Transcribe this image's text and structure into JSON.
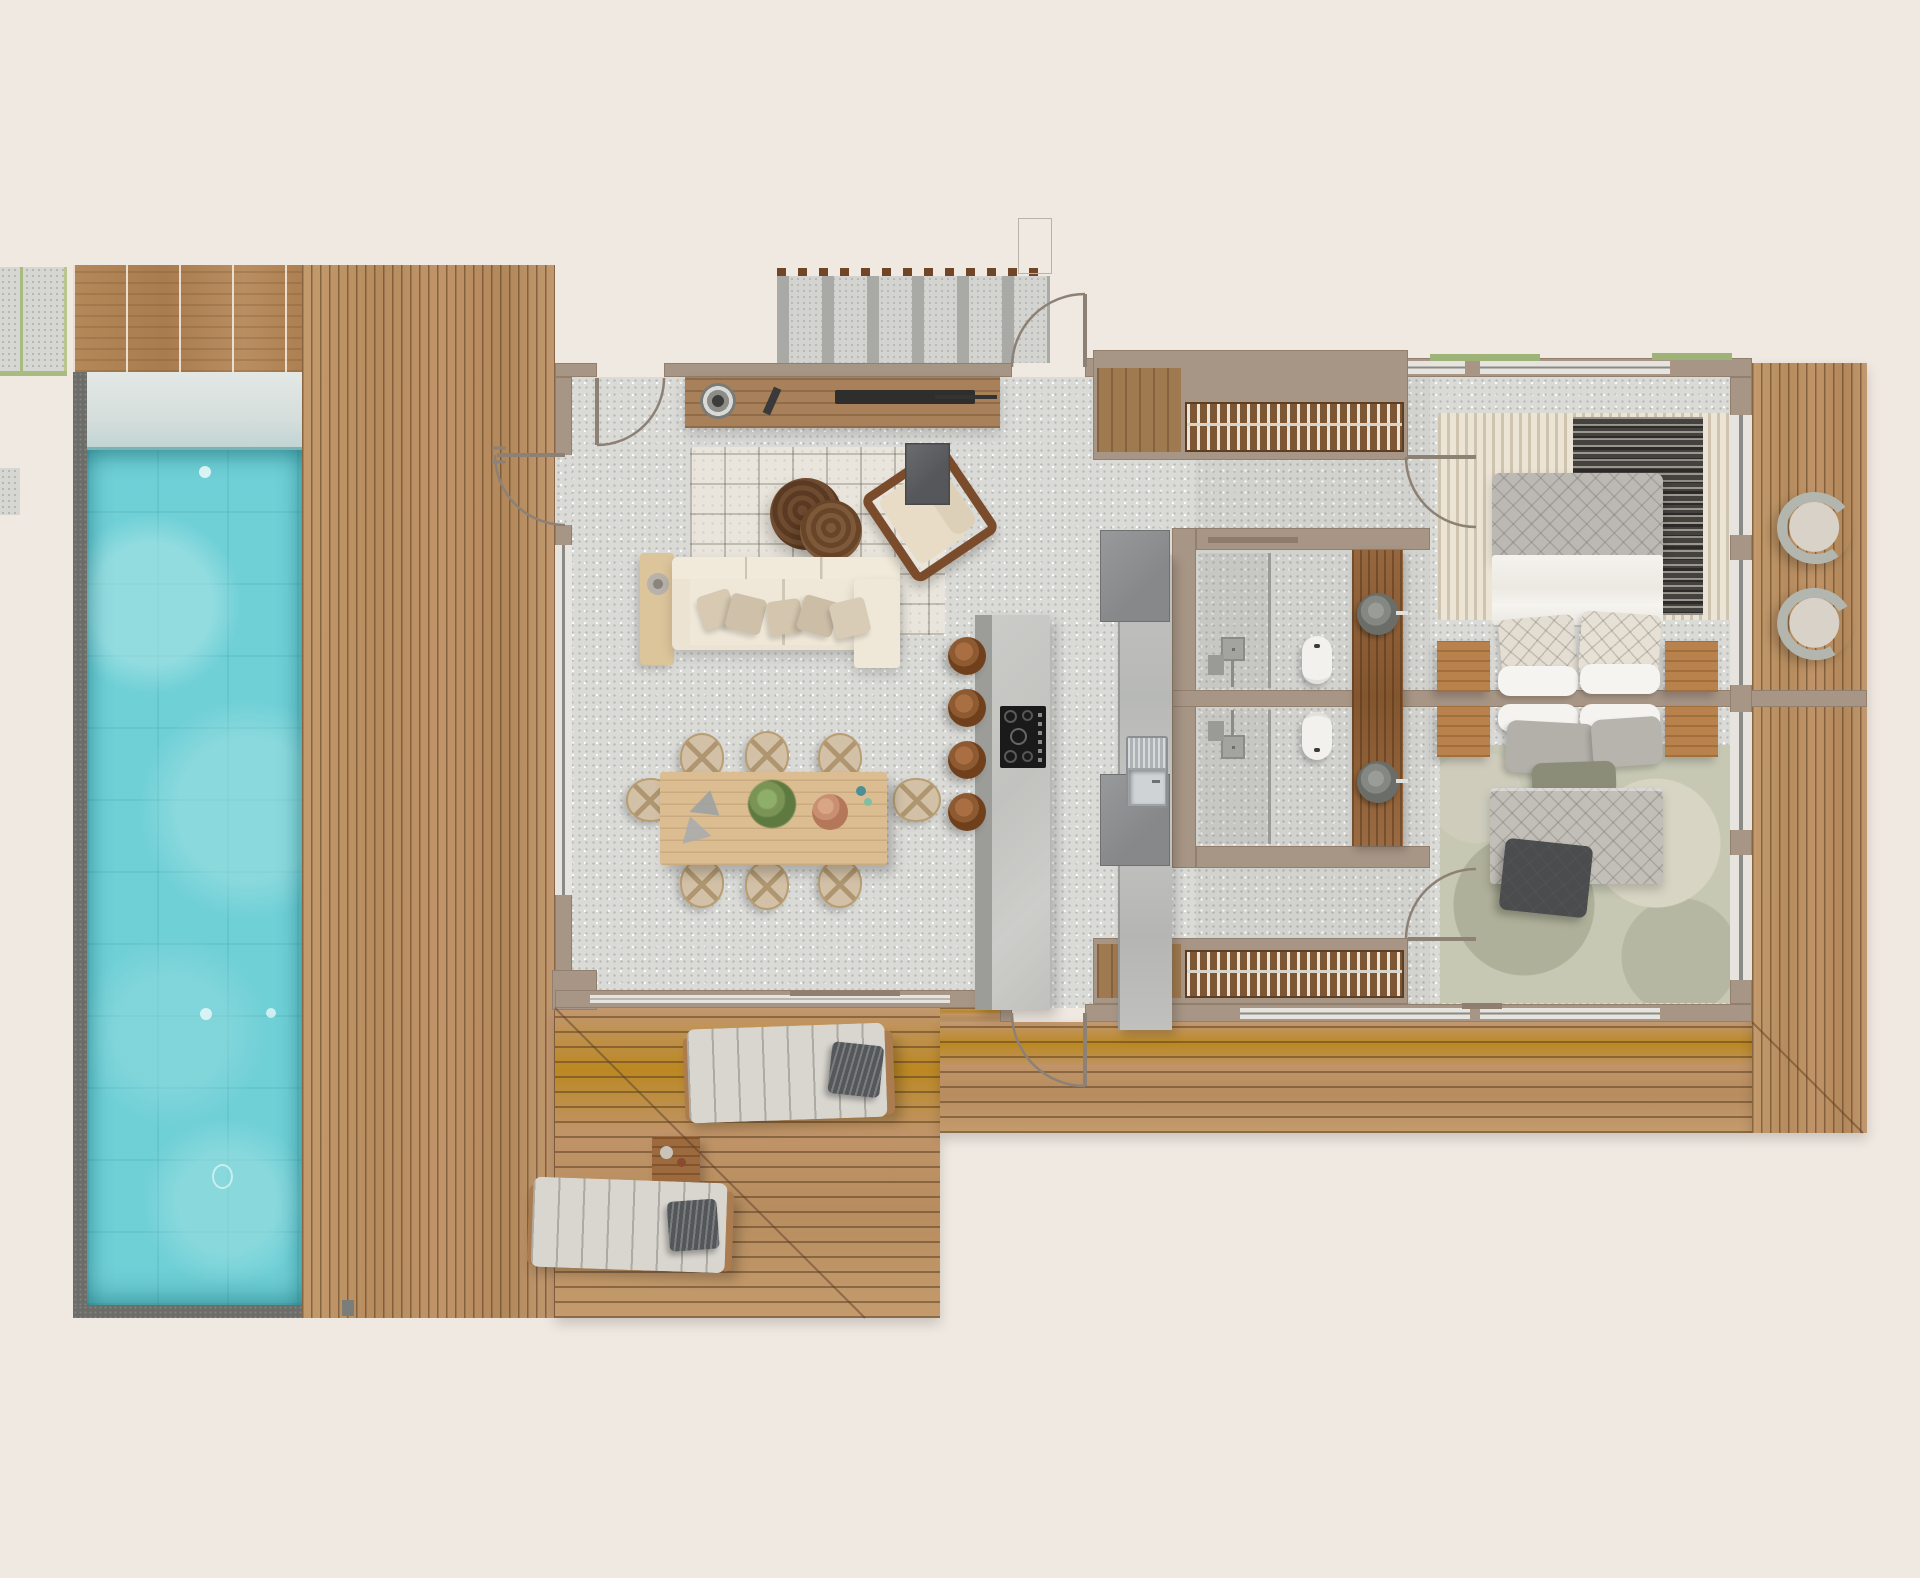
{
  "plan": {
    "type": "villa-floor-plan-top-view",
    "colors": {
      "bg": "#f0e9e1",
      "wall": "#a79585",
      "floor": "#dadad7",
      "deck_wood": "#bf9569",
      "deck_gap": "#8a6440",
      "pool_water": "#6fd0d6",
      "pool_shelf": "#dde4e0",
      "pool_coping": "#6c6c68",
      "door": "#8d8175",
      "grass": "#9db377",
      "concrete_path": "#d3d3d0",
      "path_slat": "#a9a9a6",
      "pergola_dash": "#6f4627",
      "sofa_cream": "#ece3d2",
      "pillow_beige": "#d6c8b1",
      "rug_cream": "#e9e5dc",
      "rug_dark": "#44423e",
      "rug_sage": "#c6c8b4",
      "coffee_table_walnut": "#64422a",
      "dining_table": "#dcbd91",
      "chair_seat": "#d2c1a6",
      "stool_walnut": "#8d5a32",
      "island_stone": "#c7c7c4",
      "counter_stone": "#bdbeba",
      "cooktop": "#1a1a1a",
      "stainless": "#c9cdcf",
      "fridge": "#8e908f",
      "console_wood": "#a8805a",
      "vanity_wood": "#8f603a",
      "nightstand_wood": "#b9824c",
      "rack_wood": "#7d5634",
      "rack_slat": "#eae5da",
      "headboard_grey": "#bcb8b3",
      "quilt_grey": "#c2bfb8",
      "duvet_white": "#f3f1ec",
      "fixture_white": "#f2f1ed",
      "stone_basin": "#7f817d",
      "fixture_grey": "#9e9e9b",
      "charcoal": "#4a4c4e",
      "olive": "#8c8d79",
      "lounger_cushion": "#d9d6d0"
    },
    "outdoor": {
      "pool": {
        "baja_shelf": true,
        "lights": 3,
        "drain": 1
      },
      "decks": [
        "pool-deck",
        "entry-deck",
        "sun-deck",
        "bedroom-deck"
      ],
      "sun_loungers": 2,
      "lounger_pillows": 2,
      "deck_side_table": 1,
      "curved_lounge_chairs": 2,
      "entry": {
        "path": "concrete-with-pergola-slats",
        "pergola_dashes": true
      }
    },
    "living_room": {
      "media_console": 1,
      "speaker": 1,
      "tv": 1,
      "remote": 1,
      "rug": 1,
      "coffee_tables": 2,
      "armchair": 1,
      "sofa_seats": 3,
      "sofa_pillows": 5,
      "side_table": 1
    },
    "dining": {
      "table": 1,
      "chairs": 8,
      "decor": [
        "placemats",
        "plant",
        "terracotta-bowl",
        "small-vases"
      ]
    },
    "kitchen": {
      "island": 1,
      "bar_stools": 4,
      "cooktop_burners": 5,
      "sink": 1,
      "fridges": 2,
      "drying_racks": 2,
      "appliance_unit": 1
    },
    "bathroom": {
      "showers": 2,
      "toilets": 2,
      "stone_basins": 2,
      "vanity": "timber-slab",
      "shelf_niches": 2
    },
    "bedroom": {
      "beds": 2,
      "nightstands": 4,
      "rugs": 3,
      "wardrobe_hanger_racks": 2,
      "decorative_pillows": 9
    },
    "doors": 6,
    "windows": 9
  }
}
